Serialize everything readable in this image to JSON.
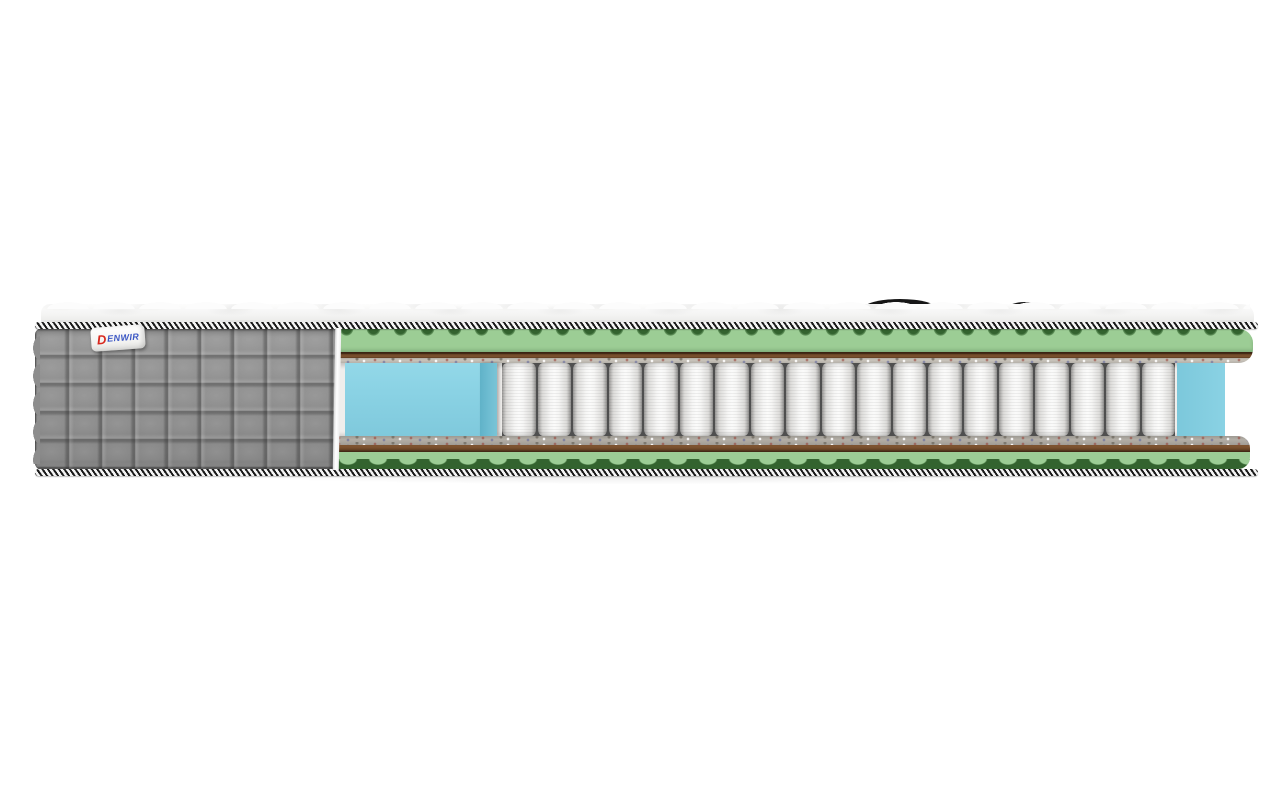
{
  "scene": {
    "subject": "mattress-cross-section",
    "brand_label": {
      "logo_d": "D",
      "logo_rest": "ENWIR"
    },
    "structure": {
      "springs_count": 19,
      "quilt_rows": 5,
      "quilt_cols": 9,
      "layers_top_to_bottom": [
        "quilted-white-top-panel",
        "striped-edge-tape",
        "wave-cut-green-foam",
        "coir-brown-layer",
        "felt-layer",
        "pocket-spring-block-with-blue-side-support-foam",
        "felt-layer",
        "coir-brown-layer",
        "wave-cut-green-foam",
        "striped-edge-tape"
      ]
    }
  },
  "colors": {
    "bg": "#ffffff",
    "fabric-gray": "#8d8d8d",
    "foam-green": "#9ccd95",
    "foam-green-dark": "#33632f",
    "coir-brown": "#6b4526",
    "coir-brown-dark": "#3a2412",
    "felt-light": "#c9c4bb",
    "felt-dark": "#b3aea6",
    "foam-blue": "#8ad2e4",
    "foam-blue-side": "#6fbdd2",
    "spring-light": "#f6f6f5",
    "spring-dark": "#a8a7a5",
    "tape-black": "#1a1a1a",
    "tape-white": "#f5f5f5",
    "label-red": "#d8281e",
    "label-blue": "#3a56c4"
  }
}
